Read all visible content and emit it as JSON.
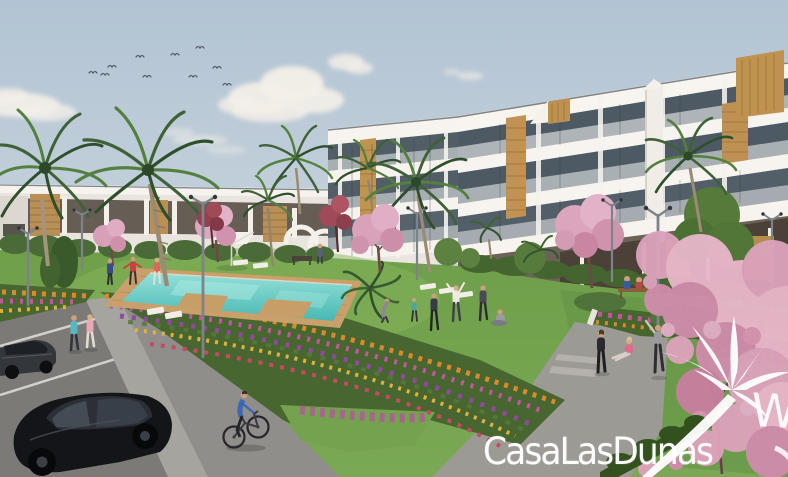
{
  "watermark": {
    "text": "CasaLasDunas",
    "partial_letter": "W",
    "icon": "palm-tree-icon",
    "color": "#ffffff"
  },
  "scene": {
    "description": "3D exterior render of a modern white apartment complex with communal pool, lawns, flower beds, palm and blossom trees, residents exercising, a cyclist and a parking lot",
    "elements": [
      "sky",
      "clouds",
      "bird-flock",
      "apartment-building",
      "terraced-houses",
      "palm-trees",
      "blossom-trees",
      "communal-pool",
      "pool-deck",
      "sun-loungers",
      "parasol",
      "street-lamps",
      "benches",
      "flower-beds",
      "lawn",
      "walking-paths",
      "parking-lot",
      "cars",
      "cyclist",
      "residents"
    ]
  },
  "palette": {
    "sky_top": "#b2c3d3",
    "sky_horizon": "#cfdadf",
    "building_white": "#f2efe9",
    "glass": "#4d5a63",
    "wood_accent": "#c09252",
    "lawn": "#74a24e",
    "pool_water": "#5fc9c2",
    "deck_wood": "#c9a06b",
    "blossom_pink": "#dca2bb",
    "flower_orange": "#d98a2c",
    "flower_magenta": "#c2579f",
    "flower_purple": "#8e4a9e",
    "path_gray": "#a6a49e",
    "asphalt": "#7b7a76",
    "hedge_green": "#3d5a2e"
  }
}
